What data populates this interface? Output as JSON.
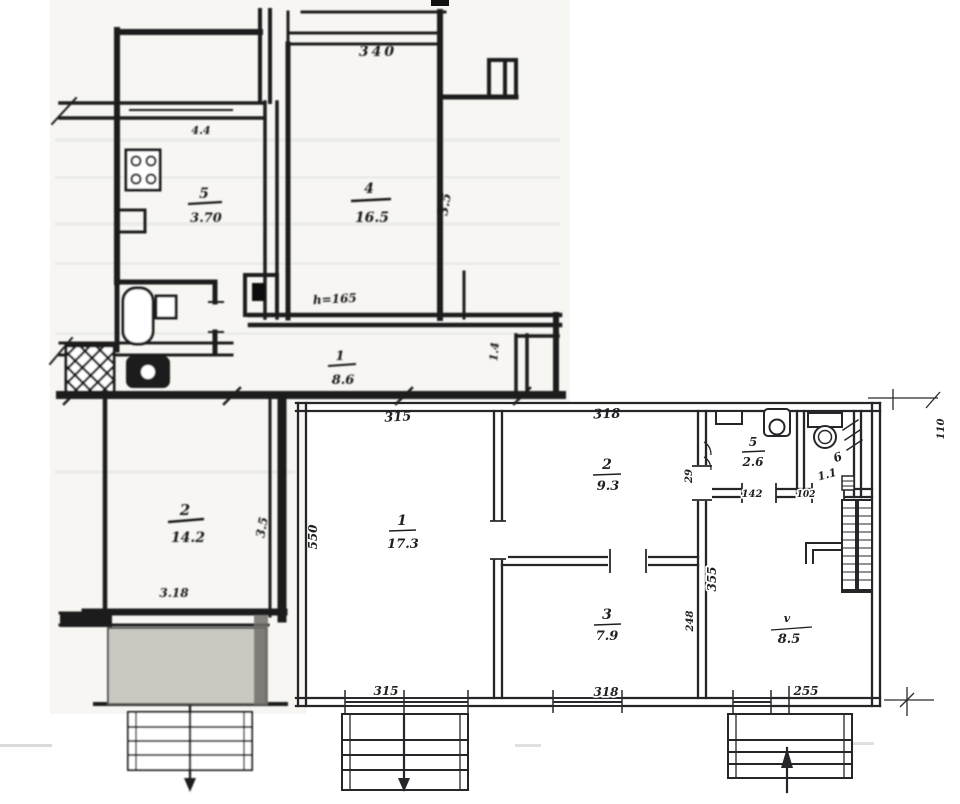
{
  "old_plan": {
    "dim_top": "340",
    "dim_window": "4.4",
    "height_note": "h=165",
    "dim_bottom": "3.18",
    "kitchen": {
      "number": "5",
      "area": "3.70"
    },
    "living_room": {
      "number": "4",
      "area": "16.5",
      "side_dim": "3.5"
    },
    "hallway": {
      "number": "1",
      "area": "8.6",
      "side_dim": "1.4"
    },
    "lower_room": {
      "number": "2",
      "area": "14.2",
      "side_dim": "3.5"
    }
  },
  "new_plan": {
    "room1": {
      "number": "1",
      "area": "17.3",
      "dim_top": "315",
      "dim_left": "550",
      "dim_bottom": "315"
    },
    "room2": {
      "number": "2",
      "area": "9.3",
      "dim_top": "318",
      "side_dim": "29"
    },
    "room3": {
      "number": "3",
      "area": "7.9",
      "dim_bottom": "318",
      "side_dim": "248"
    },
    "bathroom": {
      "number": "5",
      "area": "2.6",
      "dim_bottom": "142"
    },
    "wc": {
      "number": "6",
      "area": "1.1",
      "dim_note": "102",
      "dim_right": "110"
    },
    "kitchen": {
      "number": "v",
      "area": "8.5",
      "dim_bottom": "255"
    },
    "hall_dim": "355"
  }
}
